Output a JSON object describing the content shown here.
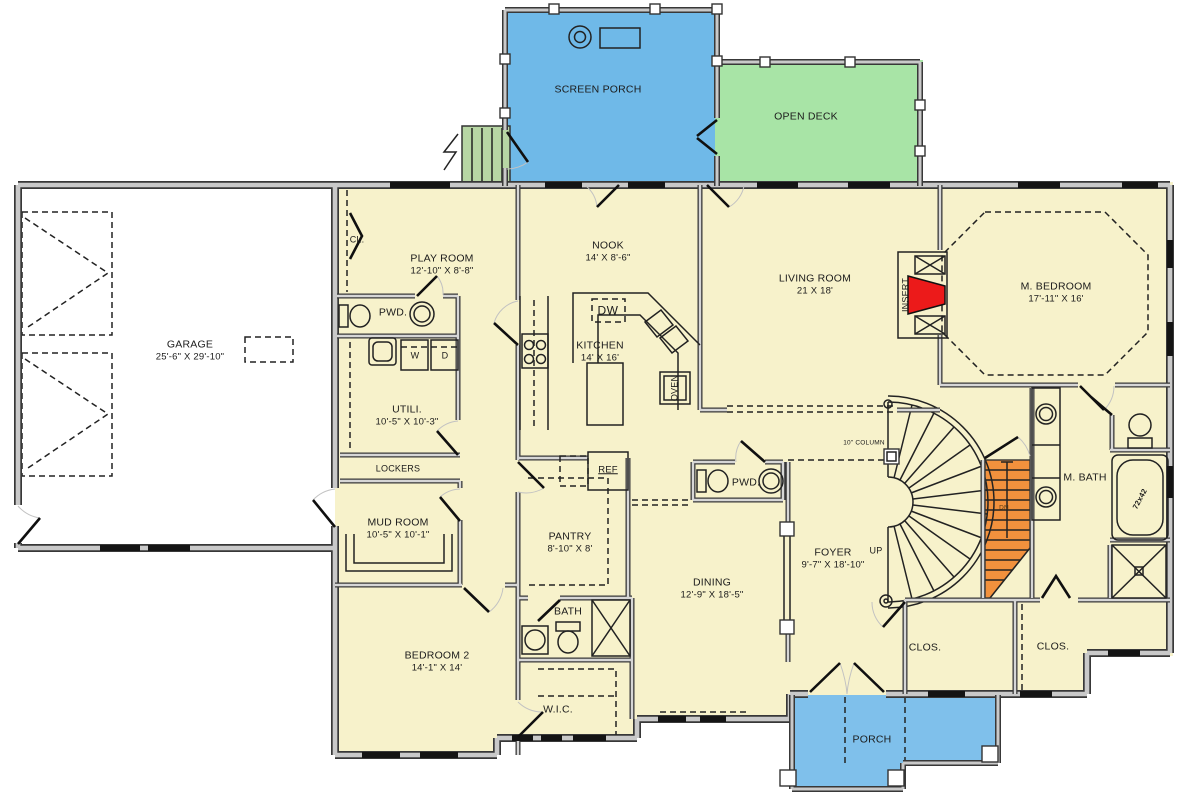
{
  "colors": {
    "floor": "#F7F2CB",
    "garage_floor": "#FFFFFF",
    "screen_porch": "#6FB9E8",
    "front_porch": "#7FC0EB",
    "open_deck": "#A8E4A6",
    "steps": "#B7D6A4",
    "stairs_down": "#F2913D",
    "fireplace_insert": "#EC1A1A",
    "walls": "#C9C9C9",
    "wall_outline": "#383838"
  },
  "rooms": {
    "screen_porch": {
      "name": "SCREEN PORCH"
    },
    "open_deck": {
      "name": "OPEN DECK"
    },
    "garage": {
      "name": "GARAGE",
      "dims": "25'-6\" X 29'-10\""
    },
    "closet_playroom": {
      "name": "CL."
    },
    "play_room": {
      "name": "PLAY ROOM",
      "dims": "12'-10\" X 8'-8\""
    },
    "nook": {
      "name": "NOOK",
      "dims": "14' X 8'-6\""
    },
    "living_room": {
      "name": "LIVING ROOM",
      "dims": "21 X 18'"
    },
    "m_bedroom": {
      "name": "M. BEDROOM",
      "dims": "17'-11\" X 16'"
    },
    "kitchen": {
      "name": "KITCHEN",
      "dims": "14' X 16'"
    },
    "powder_1": {
      "name": "PWD."
    },
    "utility": {
      "name": "UTILI.",
      "dims": "10'-5\" X 10'-3\""
    },
    "lockers": {
      "name": "LOCKERS"
    },
    "mud_room": {
      "name": "MUD ROOM",
      "dims": "10'-5\" X 10'-1\""
    },
    "pantry": {
      "name": "PANTRY",
      "dims": "8'-10\" X 8'"
    },
    "powder_2": {
      "name": "PWD."
    },
    "foyer": {
      "name": "FOYER",
      "dims": "9'-7\" X 18'-10\""
    },
    "dining": {
      "name": "DINING",
      "dims": "12'-9\" X 18'-5\""
    },
    "bedroom_2": {
      "name": "BEDROOM 2",
      "dims": "14'-1\" X 14'"
    },
    "bath": {
      "name": "BATH"
    },
    "wic": {
      "name": "W.I.C."
    },
    "m_bath": {
      "name": "M. BATH"
    },
    "closet_1": {
      "name": "CLOS."
    },
    "closet_2": {
      "name": "CLOS."
    },
    "porch": {
      "name": "PORCH"
    }
  },
  "annotations": {
    "insert": "INSERT",
    "oven": "OVEN",
    "ref": "REF",
    "dw": "DW",
    "washer": "W",
    "dryer": "D",
    "up": "UP",
    "down": "DN",
    "column": "10\" COLUMN",
    "tub_size": "72x42"
  }
}
